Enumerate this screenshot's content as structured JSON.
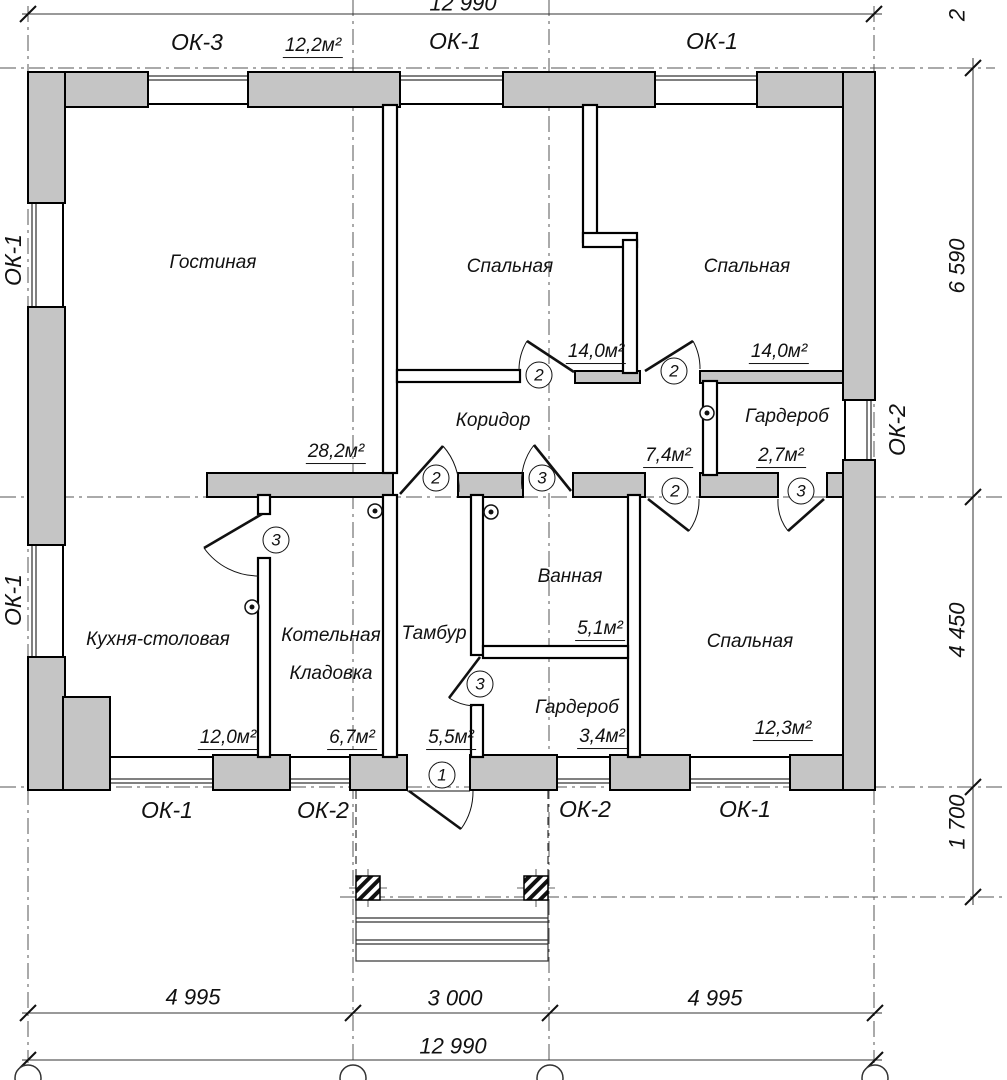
{
  "drawing_title": "План этажа (floor plan)",
  "colors": {
    "wall_fill": "#c5c5c5",
    "line": "#111111",
    "background": "#ffffff"
  },
  "rooms": [
    {
      "name": "Гостиная",
      "area": "28,2м²"
    },
    {
      "name": "Спальная",
      "area": "14,0м²"
    },
    {
      "name": "Спальная",
      "area": "14,0м²"
    },
    {
      "name": "Коридор",
      "area": "7,4м²"
    },
    {
      "name": "Гардероб",
      "area": "2,7м²"
    },
    {
      "name": "Кухня-столовая",
      "area": "12,0м²"
    },
    {
      "name": "Котельная",
      "name2": "Кладовка",
      "area": "6,7м²"
    },
    {
      "name": "Тамбур",
      "area": "5,5м²"
    },
    {
      "name": "Ванная",
      "area": "5,1м²"
    },
    {
      "name": "Гардероб",
      "area": "3,4м²"
    },
    {
      "name": "Спальная",
      "area": "12,3м²"
    }
  ],
  "extra_area_label": "12,2м²",
  "windows": {
    "top": [
      "ОК-3",
      "ОК-1",
      "ОК-1"
    ],
    "bottom": [
      "ОК-1",
      "ОК-2",
      "ОК-2",
      "ОК-1"
    ],
    "left": [
      "ОК-1",
      "ОК-1"
    ],
    "right": [
      "ОК-2"
    ]
  },
  "doors": [
    {
      "num": "1"
    },
    {
      "num": "2"
    },
    {
      "num": "2"
    },
    {
      "num": "2"
    },
    {
      "num": "3"
    },
    {
      "num": "2"
    },
    {
      "num": "3"
    },
    {
      "num": "3"
    },
    {
      "num": "3"
    }
  ],
  "dimensions": {
    "top_total": "12 990",
    "right": [
      "2",
      "6 590",
      "4 450",
      "1 700"
    ],
    "bottom_segments": [
      "4 995",
      "3 000",
      "4 995"
    ],
    "bottom_total": "12 990"
  }
}
